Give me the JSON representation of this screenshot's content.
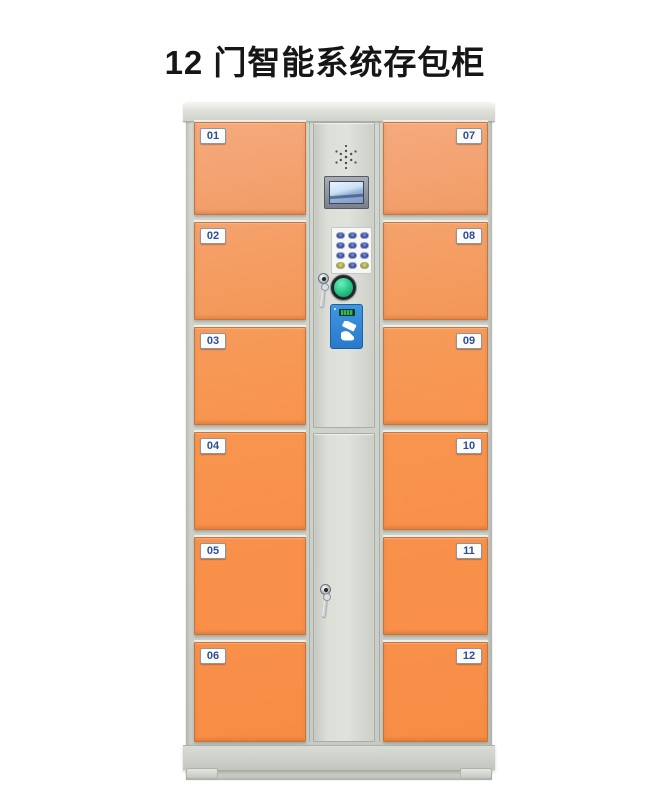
{
  "title": "12 门智能系统存包柜",
  "locker": {
    "left_doors": [
      {
        "number": "01"
      },
      {
        "number": "02"
      },
      {
        "number": "03"
      },
      {
        "number": "04"
      },
      {
        "number": "05"
      },
      {
        "number": "06"
      }
    ],
    "right_doors": [
      {
        "number": "07"
      },
      {
        "number": "08"
      },
      {
        "number": "09"
      },
      {
        "number": "10"
      },
      {
        "number": "11"
      },
      {
        "number": "12"
      }
    ],
    "control_panel": {
      "components": [
        "speaker-grill",
        "lcd-display",
        "numeric-keypad",
        "key-lock",
        "confirm-button",
        "rfid-card-reader"
      ],
      "keypad": {
        "rows": 4,
        "cols": 3
      }
    },
    "colors": {
      "door_orange": "#F8914A",
      "door_orange_light": "#F5AA7E",
      "cabinet_gray": "#D4D7D0",
      "door_label_text": "#2F4D9E",
      "card_reader_blue": "#2E86D5",
      "confirm_button_green": "#2BCC8C",
      "keypad_key_blue": "#3D52B0",
      "keypad_key_yellow": "#AEAE4E",
      "lcd_screen_blue": "#CBE1F4"
    }
  }
}
